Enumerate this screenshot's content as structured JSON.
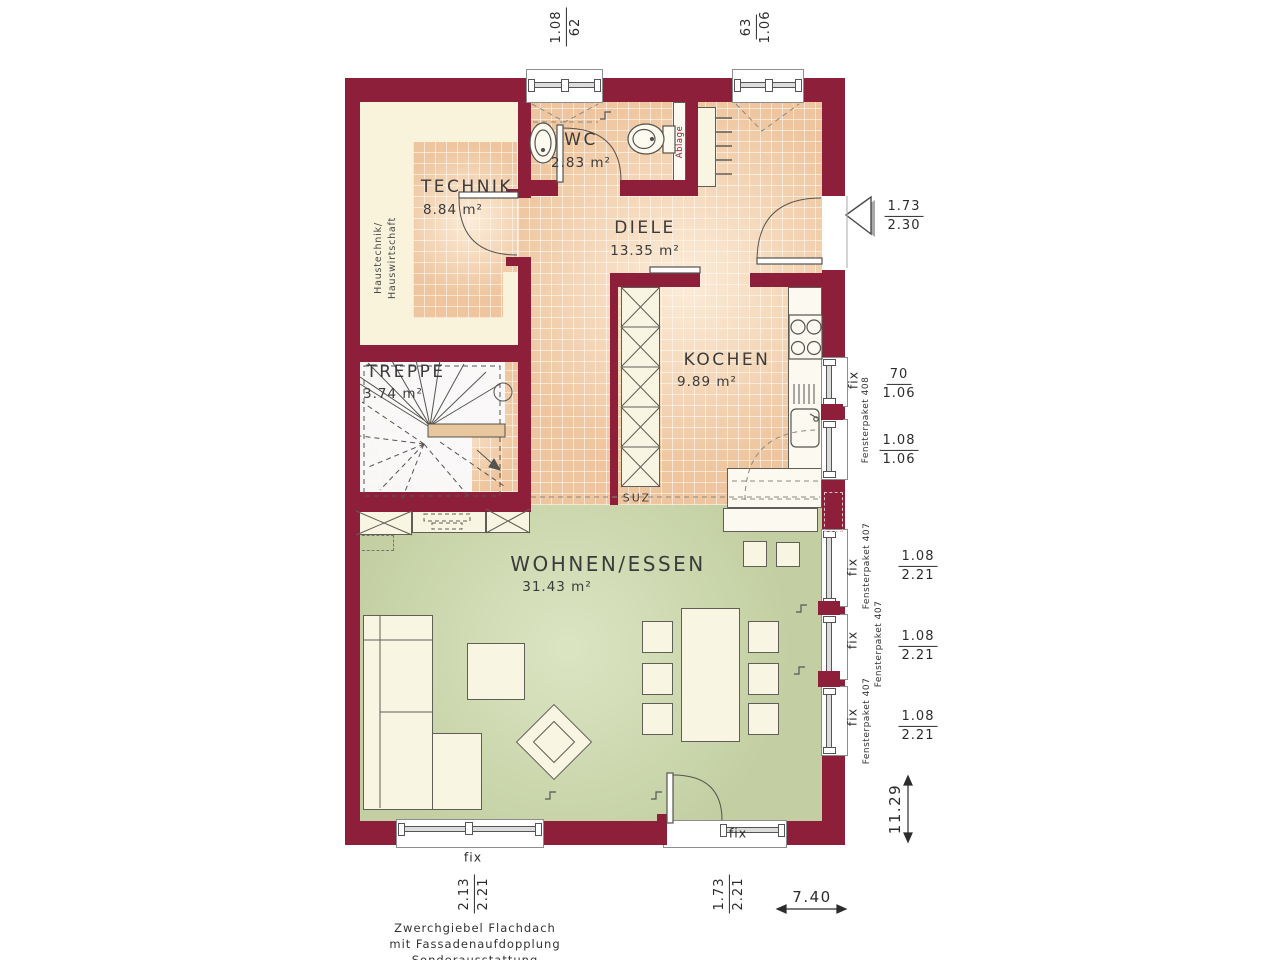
{
  "plan": {
    "rooms": {
      "technik": {
        "name": "TECHNIK",
        "area": "8.84 m²"
      },
      "wc": {
        "name": "WC",
        "area": "2.83 m²"
      },
      "diele": {
        "name": "DIELE",
        "area": "13.35 m²"
      },
      "kochen": {
        "name": "KOCHEN",
        "area": "9.89 m²"
      },
      "treppe": {
        "name": "TREPPE",
        "area": "3.74 m²"
      },
      "wohnen_essen": {
        "name": "WOHNEN/ESSEN",
        "area": "31.43 m²"
      }
    },
    "labels": {
      "haustechnik_1": "Haustechnik/",
      "haustechnik_2": "Hauswirtschaft",
      "ablage": "Ablage",
      "suz": "SUZ"
    }
  },
  "dimensions": {
    "top_window_wc": {
      "num": "1.08",
      "den": "62"
    },
    "top_window_diele": {
      "num": "63",
      "den": "1.06"
    },
    "entrance_door": {
      "num": "1.73",
      "den": "2.30"
    },
    "kitchen_window_upper": {
      "fix": "fix",
      "paket": "Fensterpaket 408",
      "num": "70",
      "den": "1.06"
    },
    "kitchen_window_lower": {
      "num": "1.08",
      "den": "1.06"
    },
    "living_windows": [
      {
        "fix": "fix",
        "paket": "Fensterpaket 407",
        "num": "1.08",
        "den": "2.21"
      },
      {
        "fix": "fix",
        "paket": "Fensterpaket 407",
        "num": "1.08",
        "den": "2.21"
      },
      {
        "fix": "fix",
        "paket": "Fensterpaket 407",
        "num": "1.08",
        "den": "2.21"
      }
    ],
    "bottom_window": {
      "fix": "fix",
      "num": "2.13",
      "den": "2.21"
    },
    "terrace_door": {
      "fix": "fix",
      "num": "1.73",
      "den": "2.21"
    },
    "total_depth": "11.29",
    "total_width": "7.40"
  },
  "footer": {
    "line1": "Zwerchgiebel Flachdach",
    "line2": "mit Fassadenaufdopplung",
    "line3": "Sonderausstattung"
  },
  "colors": {
    "wall": "#8e1f3a",
    "tile_floor": "#eec59e",
    "living_floor": "#c3cfa2",
    "installation_zone": "#f8f3da",
    "furniture": "#f8f5e2"
  }
}
